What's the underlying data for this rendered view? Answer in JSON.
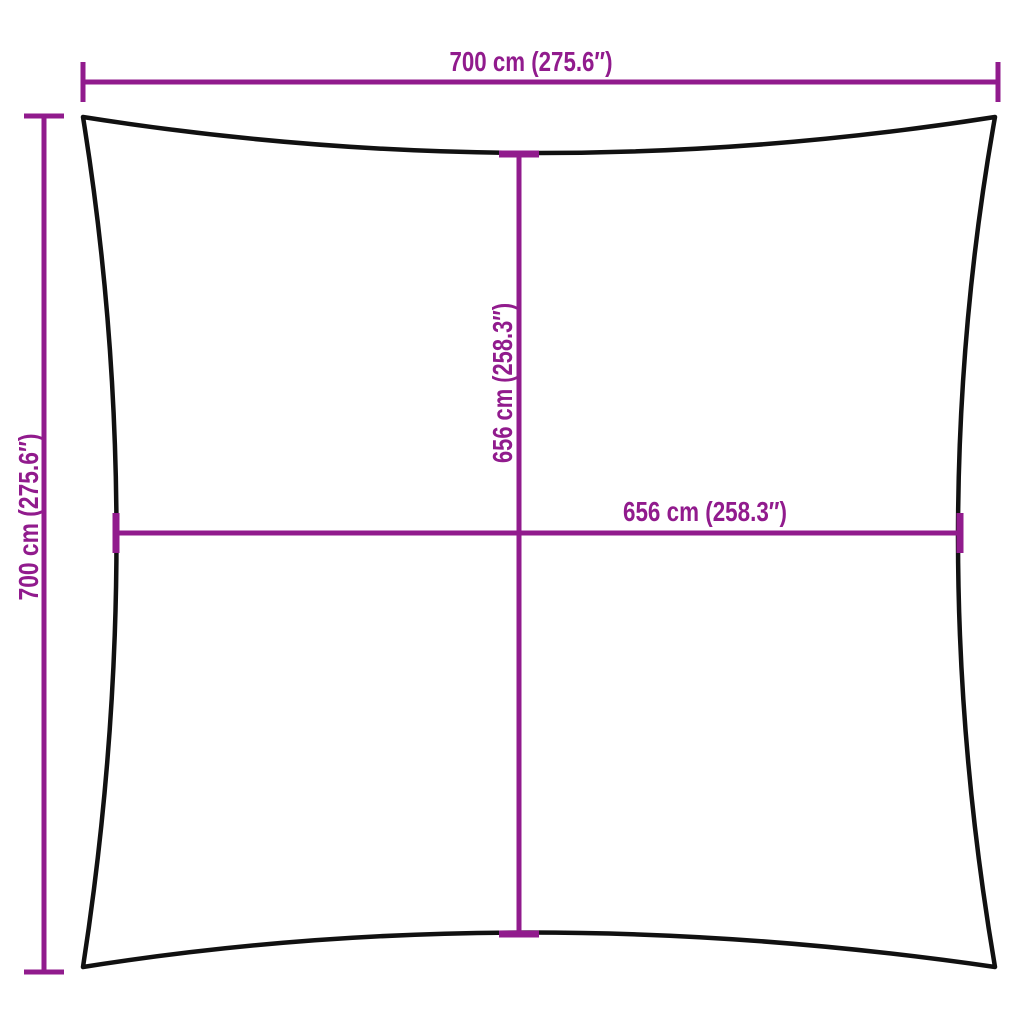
{
  "page": {
    "background_color": "#ffffff"
  },
  "diagram": {
    "kind": "shade-sail-dimension-diagram",
    "outline_color": "#111111",
    "dimension_color": "#911B8D",
    "labels": {
      "top_width": "700 cm (275.6″)",
      "left_height": "700 cm (275.6″)",
      "inner_height": "656 cm (258.3″)",
      "inner_width": "656 cm (258.3″)"
    },
    "measurements": {
      "outer_width_cm": 700,
      "outer_width_in": 275.6,
      "outer_height_cm": 700,
      "outer_height_in": 275.6,
      "inner_width_cm": 656,
      "inner_width_in": 258.3,
      "inner_height_cm": 656,
      "inner_height_in": 258.3
    }
  }
}
